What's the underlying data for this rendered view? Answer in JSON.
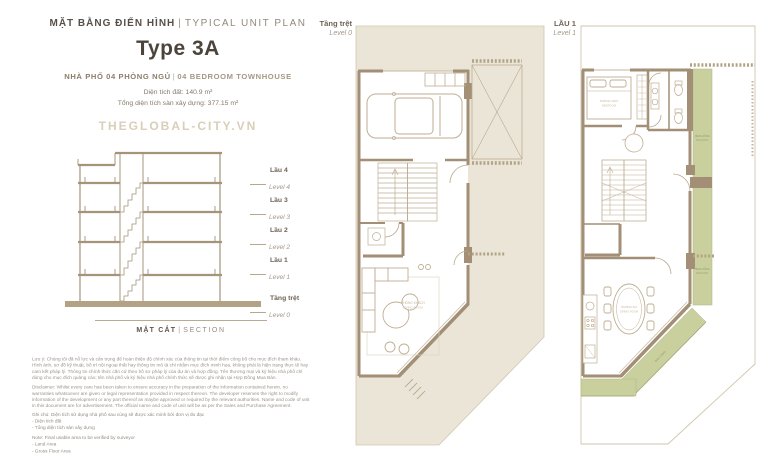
{
  "colors": {
    "background": "#FFFFFF",
    "parcel_beige": "#EBE5D8",
    "wall_brown": "#A28F75",
    "furniture_line": "#BFAE93",
    "balcony_green": "#C9D09E",
    "text_dark": "#57504A",
    "text_brown": "#8C7D68",
    "text_light": "#A3988A",
    "watermark": "#D9CEB8"
  },
  "header": {
    "title_vi": "MẶT BẰNG ĐIỂN HÌNH",
    "title_divider": "|",
    "title_en": "TYPICAL UNIT PLAN",
    "unit_type": "Type 3A",
    "subtitle_vi": "NHÀ PHỐ 04 PHÒNG NGỦ",
    "subtitle_divider": "|",
    "subtitle_en": "04 BEDROOM TOWNHOUSE",
    "land_area": "Diện tích đất: 140.9 m²",
    "gfa": "Tổng diện tích sàn xây dựng: 377.15 m²",
    "watermark": "THEGLOBAL-CITY.VN"
  },
  "section_elevation": {
    "caption_vi": "MẶT CẮT",
    "caption_divider": "|",
    "caption_en": "SECTION",
    "floors": [
      {
        "vi": "Lầu 4",
        "en": "Level 4"
      },
      {
        "vi": "Lầu 3",
        "en": "Level 3"
      },
      {
        "vi": "Lầu 2",
        "en": "Level 2"
      },
      {
        "vi": "Lầu 1",
        "en": "Level 1"
      },
      {
        "vi": "Tầng trệt",
        "en": "Level 0"
      }
    ]
  },
  "plans": {
    "level0": {
      "label_vi": "Tầng trệt",
      "label_en": "Level 0",
      "labels": {
        "living_vi": "PHÒNG KHÁCH",
        "living_en": "LIVING ROOM"
      }
    },
    "level1": {
      "label_vi": "LẦU 1",
      "label_en": "Level 1",
      "labels": {
        "bedroom_vi": "PHÒNG NGỦ",
        "bedroom_en": "BEDROOM",
        "dining_vi": "PHÒNG ĂN",
        "dining_en": "DINING ROOM",
        "balcony_vi": "BAN CÔNG",
        "balcony_en": "BALCONY"
      }
    }
  },
  "disclaimer": {
    "vi": "Lưu ý: Chúng tôi đã nỗ lực và cẩn trọng để hoàn thiện độ chính xác của thông tin tại thời điểm công bố cho mục đích tham khảo. Hình ảnh, sơ đồ kỹ thuật, bố trí nội ngoại thất hay thông tin mô tả chỉ nhằm mục đích minh họa, không phải là hiện trạng thực tế hay cam kết pháp lý. Thông tin chính thức căn cứ theo hồ sơ pháp lý của dự án và hợp đồng. Tên thương mại và ký hiệu nhà phố chỉ dùng cho mục đích quảng cáo; tên nhà phố và ký hiệu nhà phố chính thức sẽ được ghi nhận tại Hợp Đồng Mua Bán.",
    "en": "Disclaimer: Whilst every care has been taken to ensure accuracy in the preparation of the information contained herein, no warranties whatsoever are given or legal representation provided in respect thereon. The developer reserves the right to modify information of the development or any part thereof as maybe approved or required by the relevant authorities. Name and code of unit in this document are for advertisement. The official name and code of unit will be as per the Sales and Purchase Agreement."
  },
  "notes": {
    "vi_title": "Ghi chú: Diện tích sử dụng nhà phố sau cùng sẽ được xác minh bởi đơn vị đo đạc",
    "vi_item_1": "- Diện tích đất",
    "vi_item_2": "- Tổng diện tích sàn xây dựng",
    "en_title": "Note: Final usable area to be verified by surveyor",
    "en_item_1": "- Land Area",
    "en_item_2": "- Gross Floor Area"
  }
}
